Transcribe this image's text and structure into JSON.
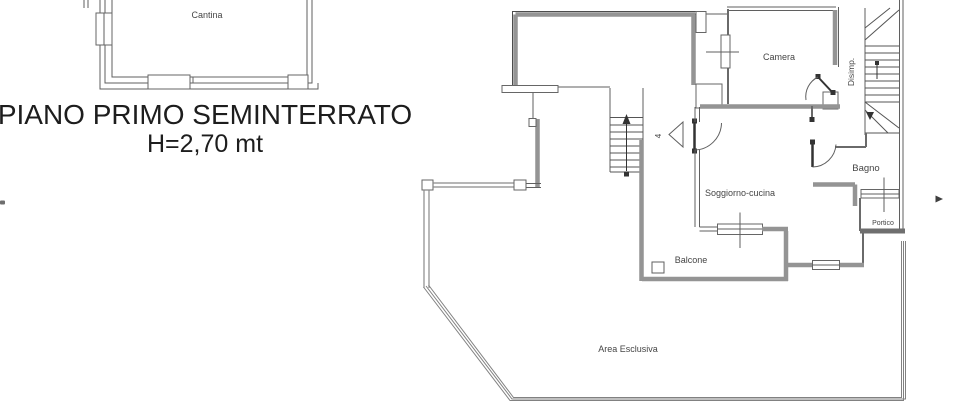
{
  "title": {
    "line1": "PIANO PRIMO SEMINTERRATO",
    "line2": "H=2,70 mt"
  },
  "rooms": {
    "cantina": "Cantina",
    "camera": "Camera",
    "disimpegno": "Disimp.",
    "soggiorno": "Soggiorno-cucina",
    "bagno": "Bagno",
    "portico": "Portico",
    "balcone": "Balcone",
    "area_esclusiva": "Area Esclusiva",
    "door_number": "4"
  },
  "colors": {
    "background": "#ffffff",
    "wall_grey": "#949494",
    "wall_line": "#5f5f5f",
    "label_text": "#454545",
    "title_text": "#1d1d1d"
  }
}
